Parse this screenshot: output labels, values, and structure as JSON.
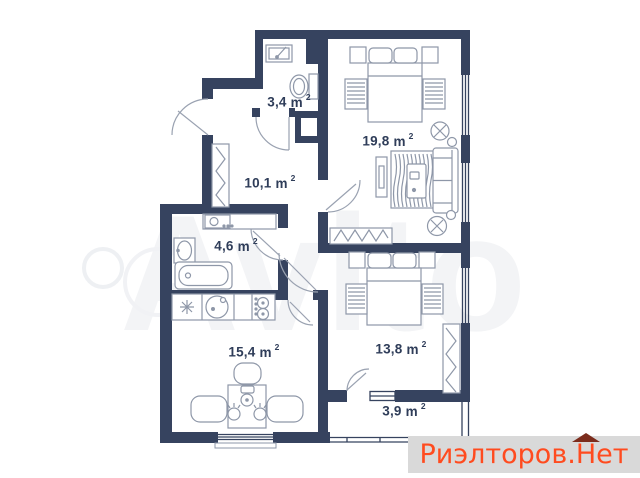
{
  "watermark": {
    "text": "Avito"
  },
  "branding": {
    "name": "Риэлторов.",
    "suffix": "Нет"
  },
  "plan": {
    "unit": "m",
    "sup": "2",
    "rooms": [
      {
        "id": "wc",
        "area": "3,4"
      },
      {
        "id": "hallway",
        "area": "10,1"
      },
      {
        "id": "living-bedroom",
        "area": "19,8"
      },
      {
        "id": "bathroom",
        "area": "4,6"
      },
      {
        "id": "kitchen",
        "area": "15,4"
      },
      {
        "id": "bedroom",
        "area": "13,8"
      },
      {
        "id": "balcony",
        "area": "3,9"
      }
    ],
    "colors": {
      "wall": "#36435f",
      "furniture": "#8e97a8",
      "door": "#9aa2b1",
      "label": "#2f3d59",
      "brand_text": "#ff4b1f",
      "brand_roof": "#7b2c1c",
      "brand_bar_bg": "#d9d9d9"
    }
  }
}
